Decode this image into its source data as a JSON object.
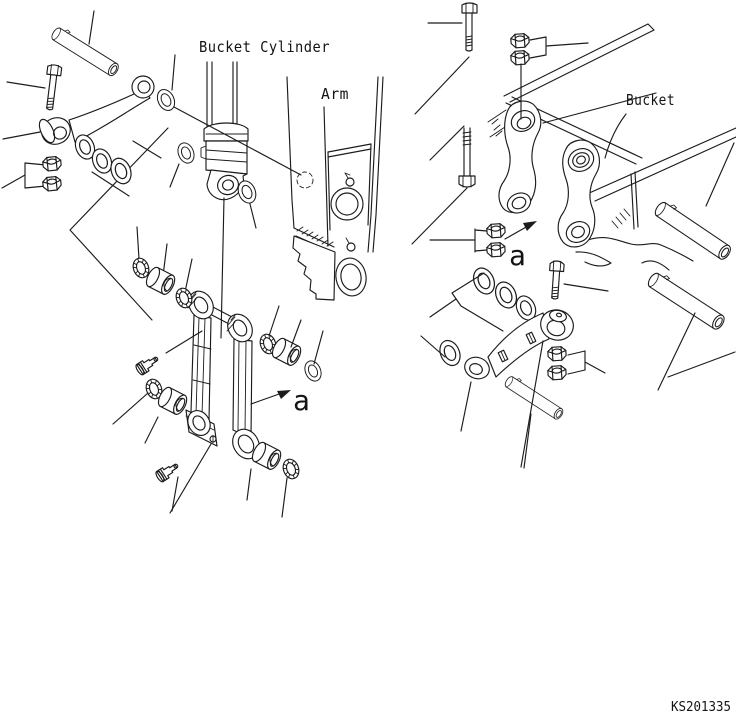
{
  "labels": {
    "bucket_cylinder": "Bucket Cylinder",
    "arm": "Arm",
    "bucket": "Bucket"
  },
  "markers": {
    "bucket_link_view": "a",
    "idler_link_view": "a"
  },
  "drawing_number": "KS201335",
  "colors": {
    "line": "#1c1c1c",
    "background": "#ffffff",
    "text": "#141414"
  }
}
